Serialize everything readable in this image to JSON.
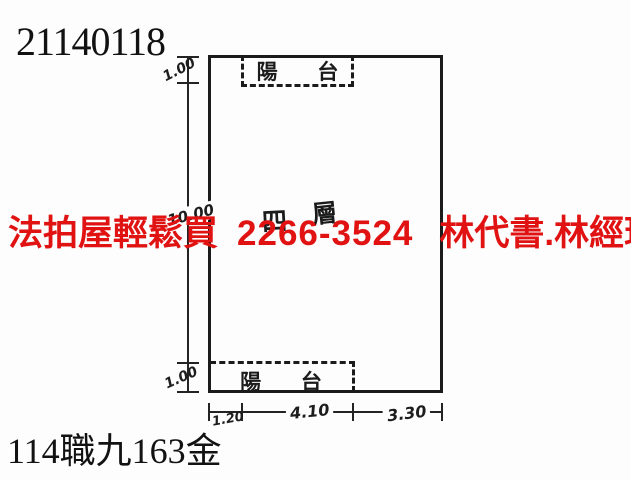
{
  "document": {
    "plan_id": "21140118",
    "case_number": "114職九163金"
  },
  "watermark": {
    "agency": "法拍屋輕鬆買",
    "phone": "2266-3524",
    "contacts": "林代書.林經理",
    "color": "#e01212"
  },
  "floorplan": {
    "floor_label": {
      "char1": "四",
      "char2": "層"
    },
    "balcony_top_label": "陽 台",
    "balcony_bottom_label": "陽 台",
    "line_color": "#1b1b1b",
    "dimensions": {
      "left_balcony_top": "1.00",
      "left_body": "10.00",
      "left_balcony_bottom": "1.00",
      "bottom_left": "1.20",
      "bottom_middle": "4.10",
      "bottom_right": "3.30"
    }
  }
}
